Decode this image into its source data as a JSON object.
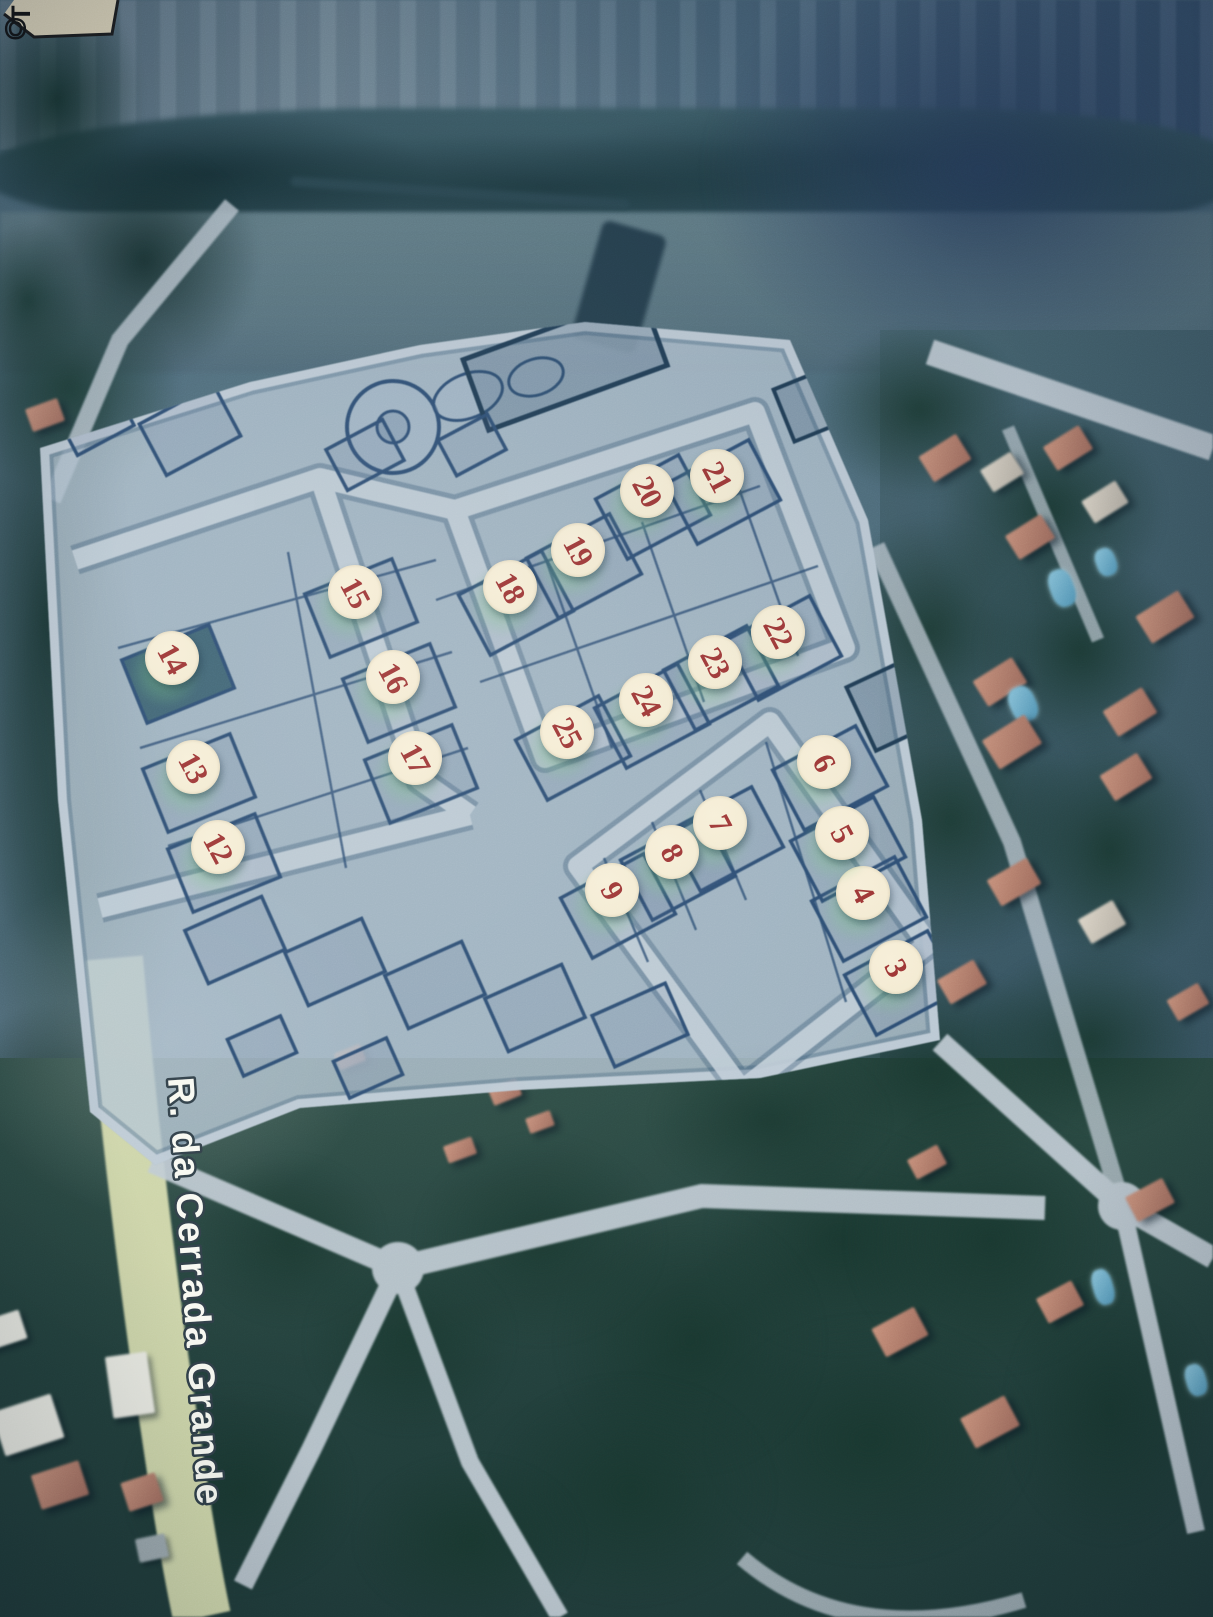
{
  "scene": {
    "street_label": "R. da Cerrada Grande",
    "corner_label_top": "T",
    "corner_label_bottom": "O",
    "markers": [
      {
        "label": "3",
        "x": 896,
        "y": 967
      },
      {
        "label": "4",
        "x": 863,
        "y": 893
      },
      {
        "label": "5",
        "x": 842,
        "y": 833
      },
      {
        "label": "6",
        "x": 824,
        "y": 762
      },
      {
        "label": "7",
        "x": 720,
        "y": 823
      },
      {
        "label": "8",
        "x": 672,
        "y": 852
      },
      {
        "label": "9",
        "x": 612,
        "y": 890
      },
      {
        "label": "12",
        "x": 218,
        "y": 847
      },
      {
        "label": "13",
        "x": 193,
        "y": 767
      },
      {
        "label": "14",
        "x": 172,
        "y": 658
      },
      {
        "label": "15",
        "x": 355,
        "y": 592
      },
      {
        "label": "16",
        "x": 393,
        "y": 677
      },
      {
        "label": "17",
        "x": 415,
        "y": 758
      },
      {
        "label": "18",
        "x": 510,
        "y": 587
      },
      {
        "label": "19",
        "x": 578,
        "y": 550
      },
      {
        "label": "20",
        "x": 647,
        "y": 491
      },
      {
        "label": "21",
        "x": 717,
        "y": 476
      },
      {
        "label": "22",
        "x": 778,
        "y": 632
      },
      {
        "label": "23",
        "x": 715,
        "y": 662
      },
      {
        "label": "24",
        "x": 646,
        "y": 700
      },
      {
        "label": "25",
        "x": 567,
        "y": 732
      }
    ],
    "colors": {
      "marker_fill": "#f3ead0",
      "marker_text": "#9c3433",
      "plan_line": "#2b4c72",
      "plan_paper": "#b3c4d2",
      "road_light": "#c0cbd4",
      "road_yellow": "#d6dcae",
      "street_label_fill": "#f8f9f2",
      "street_label_outline": "#2f3e47"
    }
  }
}
